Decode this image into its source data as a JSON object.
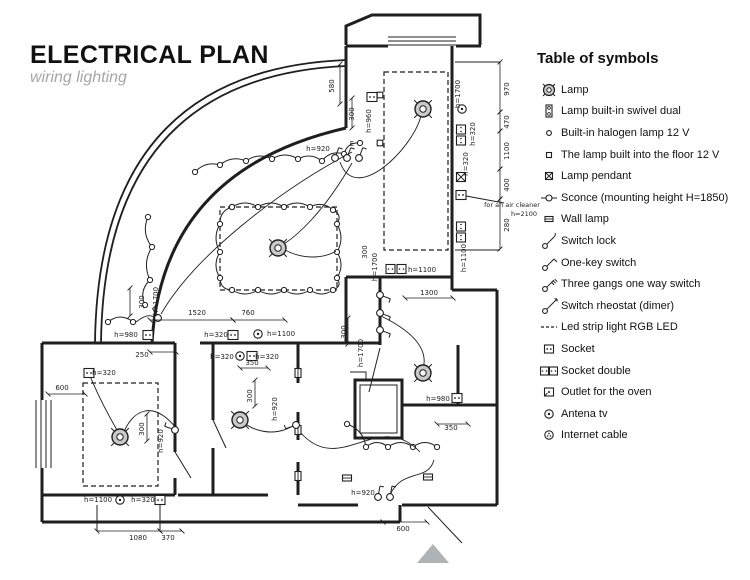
{
  "header": {
    "title": "ELECTRICAL PLAN",
    "subtitle": "wiring lighting"
  },
  "legend": {
    "title": "Table of symbols",
    "items": [
      {
        "icon": "lamp-icon",
        "label": "Lamp"
      },
      {
        "icon": "swivel-dual-lamp-icon",
        "label": "Lamp built-in swivel dual"
      },
      {
        "icon": "halogen-lamp-icon",
        "label": "Built-in halogen lamp 12 V"
      },
      {
        "icon": "floor-lamp-icon",
        "label": "The lamp built into the floor 12 V"
      },
      {
        "icon": "pendant-lamp-icon",
        "label": "Lamp pendant"
      },
      {
        "icon": "sconce-icon",
        "label": "Sconce (mounting height H=1850)"
      },
      {
        "icon": "wall-lamp-icon",
        "label": "Wall lamp"
      },
      {
        "icon": "switch-lock-icon",
        "label": "Switch lock"
      },
      {
        "icon": "one-key-switch-icon",
        "label": "One-key switch"
      },
      {
        "icon": "three-gangs-switch-icon",
        "label": "Three gangs one way switch"
      },
      {
        "icon": "switch-rheostat-icon",
        "label": "Switch rheostat (dimer)"
      },
      {
        "icon": "led-strip-icon",
        "label": "Led strip light RGB LED"
      },
      {
        "icon": "socket-icon",
        "label": "Socket"
      },
      {
        "icon": "socket-double-icon",
        "label": "Socket double"
      },
      {
        "icon": "oven-outlet-icon",
        "label": "Outlet for the oven"
      },
      {
        "icon": "antena-tv-icon",
        "label": "Antena tv"
      },
      {
        "icon": "internet-cable-icon",
        "label": "Internet cable"
      }
    ]
  },
  "plan": {
    "ink": "#1f1f1f",
    "lamp_fill": "#c9c9c9",
    "north_fill": "#b0b3b6",
    "walls_thick": [
      "M346,45 L346,26 L372,15 L480,15 L480,45",
      "M346,46 L388,46",
      "M456,46 L481,46",
      "M452,46 L452,290",
      "M346,277 L452,277",
      "M346,277 L346,343",
      "M380,277 L380,345",
      "M452,290 L497,290",
      "M497,290 L497,505",
      "M403,405 L497,405",
      "M458,345 L458,405",
      "M497,505 L430,505",
      "M400,505 L400,522",
      "M400,522 L42,522",
      "M42,522 L42,468",
      "M42,400 L42,343",
      "M42,343 L175,343",
      "M200,343 L380,343",
      "M175,343 L175,452",
      "M175,478 L175,495",
      "M42,495 L175,495",
      "M213,343 L213,420",
      "M213,448 L213,495",
      "M178,495 L268,495",
      "M298,343 L298,383",
      "M298,412 L298,440",
      "M298,462 L298,495",
      "M298,505 L358,505",
      "M402,505 L430,505",
      "M152,343 Q162,170 346,128",
      "M346,128 L346,46",
      "M355,380 L402,380 L402,438 L355,438 Z"
    ],
    "walls_med": [
      "M95,343 Q98,70 346,60",
      "M101,343 Q104,77 346,66"
    ],
    "walls_thin": [
      "M388,37 L456,37",
      "M388,41 L456,41",
      "M388,45 L456,45",
      "M36,400 L36,468",
      "M41,400 L41,468",
      "M46,400 L46,468",
      "M51,400 L51,468",
      "M360,385 L397,385 L397,433 L360,433 Z",
      "M350,372 L366,372 L366,380",
      "M175,452 L191,478",
      "M380,348 L369,392",
      "M428,507 L462,543",
      "M213,420 L226,448",
      "M455,62 L500,62",
      "M455,250 L500,250",
      "M466,196 L504,203",
      "M97,505 L97,531",
      "M160,505 L160,531"
    ],
    "dashed_rects": [
      [
        220,
        207,
        117,
        83
      ],
      [
        384,
        72,
        64,
        178
      ],
      [
        83,
        383,
        75,
        103
      ]
    ],
    "strings": [
      {
        "b": 9,
        "pts": [
          [
            148,
            217
          ],
          [
            152,
            247
          ],
          [
            150,
            280
          ],
          [
            145,
            305
          ]
        ]
      },
      {
        "b": -8,
        "pts": [
          [
            195,
            172
          ],
          [
            220,
            165
          ],
          [
            246,
            161
          ],
          [
            272,
            159
          ],
          [
            298,
            159
          ],
          [
            322,
            161
          ],
          [
            344,
            154
          ],
          [
            360,
            143
          ]
        ]
      },
      {
        "b": -9,
        "pts": [
          [
            347,
            424
          ],
          [
            366,
            447
          ],
          [
            388,
            447
          ],
          [
            413,
            447
          ],
          [
            437,
            447
          ]
        ]
      },
      {
        "b": -8,
        "pts": [
          [
            232,
            207
          ],
          [
            258,
            207
          ],
          [
            284,
            207
          ],
          [
            310,
            207
          ],
          [
            333,
            210
          ],
          [
            337,
            224
          ],
          [
            337,
            252
          ],
          [
            337,
            278
          ],
          [
            333,
            290
          ],
          [
            310,
            290
          ],
          [
            284,
            290
          ],
          [
            258,
            290
          ],
          [
            232,
            290
          ],
          [
            220,
            278
          ],
          [
            220,
            252
          ],
          [
            220,
            224
          ],
          [
            232,
            207
          ]
        ]
      },
      {
        "b": -10,
        "pts": [
          [
            108,
            322
          ],
          [
            133,
            322
          ]
        ]
      }
    ],
    "lamps": [
      [
        423,
        109
      ],
      [
        278,
        248
      ],
      [
        120,
        437
      ],
      [
        240,
        420
      ],
      [
        423,
        373
      ]
    ],
    "symbols": [
      {
        "x": 372,
        "y": 97,
        "k": "single",
        "rot": 0
      },
      {
        "x": 380,
        "y": 95,
        "k": "floor",
        "rot": 0
      },
      {
        "x": 380,
        "y": 143,
        "k": "floor",
        "rot": 0
      },
      {
        "x": 462,
        "y": 109,
        "k": "antena",
        "rot": 0
      },
      {
        "x": 461,
        "y": 135,
        "k": "double",
        "rot": 90
      },
      {
        "x": 461,
        "y": 177,
        "k": "pendant",
        "rot": 0
      },
      {
        "x": 461,
        "y": 195,
        "k": "single",
        "rot": 0
      },
      {
        "x": 461,
        "y": 232,
        "k": "double",
        "rot": 90
      },
      {
        "x": 396,
        "y": 269,
        "k": "double",
        "rot": 0
      },
      {
        "x": 148,
        "y": 335,
        "k": "single",
        "rot": 0
      },
      {
        "x": 233,
        "y": 335,
        "k": "single",
        "rot": 0
      },
      {
        "x": 258,
        "y": 334,
        "k": "antena",
        "rot": 0
      },
      {
        "x": 240,
        "y": 356,
        "k": "antena",
        "rot": 0
      },
      {
        "x": 252,
        "y": 356,
        "k": "single",
        "rot": 0
      },
      {
        "x": 89,
        "y": 373,
        "k": "single",
        "rot": 0
      },
      {
        "x": 120,
        "y": 500,
        "k": "antena",
        "rot": 0
      },
      {
        "x": 160,
        "y": 500,
        "k": "single",
        "rot": 0
      },
      {
        "x": 457,
        "y": 398,
        "k": "single",
        "rot": 0
      },
      {
        "x": 298,
        "y": 373,
        "k": "wall",
        "rot": 90
      },
      {
        "x": 298,
        "y": 430,
        "k": "wall",
        "rot": 90
      },
      {
        "x": 298,
        "y": 476,
        "k": "wall",
        "rot": 90
      },
      {
        "x": 347,
        "y": 478,
        "k": "wall",
        "rot": 0
      },
      {
        "x": 428,
        "y": 477,
        "k": "wall",
        "rot": 0
      }
    ],
    "switches": [
      {
        "x": 335,
        "y": 158,
        "a": -70
      },
      {
        "x": 347,
        "y": 158,
        "a": -70
      },
      {
        "x": 359,
        "y": 158,
        "a": -70
      },
      {
        "x": 380,
        "y": 295,
        "a": 20
      },
      {
        "x": 380,
        "y": 313,
        "a": 20
      },
      {
        "x": 380,
        "y": 330,
        "a": 20
      },
      {
        "x": 175,
        "y": 430,
        "a": -160
      },
      {
        "x": 296,
        "y": 425,
        "a": 160
      },
      {
        "x": 158,
        "y": 318,
        "a": -120
      },
      {
        "x": 378,
        "y": 497,
        "a": -80
      },
      {
        "x": 390,
        "y": 497,
        "a": -80
      }
    ],
    "wires": [
      "M340,162 C355,205 412,150 421,116",
      "M352,163 C322,215 296,236 284,244",
      "M381,316 C418,334 428,352 423,369",
      "M176,428 C152,398 132,412 124,432",
      "M90,376 C100,400 110,418 117,430",
      "M296,424 C272,440 250,428 243,422",
      "M352,152 C280,190 195,255 161,314",
      "M285,250 C308,262 328,256 336,251",
      "M300,432 C340,478 378,408 420,452",
      "M390,495 C402,468 428,482 434,460",
      "M136,322 C146,314 152,314 156,319"
    ],
    "dims": [
      [
        500,
        62,
        500,
        112
      ],
      [
        500,
        112,
        500,
        131
      ],
      [
        500,
        131,
        500,
        169
      ],
      [
        500,
        169,
        500,
        199
      ],
      [
        500,
        199,
        500,
        249
      ],
      [
        150,
        320,
        233,
        320
      ],
      [
        233,
        320,
        285,
        320
      ],
      [
        405,
        298,
        453,
        298
      ],
      [
        97,
        531,
        160,
        531
      ],
      [
        160,
        531,
        182,
        531
      ],
      [
        383,
        522,
        427,
        522
      ],
      [
        48,
        394,
        85,
        394
      ],
      [
        437,
        424,
        468,
        424
      ],
      [
        240,
        368,
        268,
        368
      ],
      [
        130,
        288,
        130,
        316
      ],
      [
        255,
        380,
        255,
        406
      ],
      [
        147,
        414,
        147,
        441
      ],
      [
        348,
        318,
        348,
        344
      ],
      [
        340,
        64,
        340,
        104
      ],
      [
        352,
        98,
        352,
        128
      ],
      [
        150,
        352,
        176,
        352
      ]
    ],
    "labels": [
      {
        "x": 334,
        "y": 86,
        "t": "580",
        "r": -90
      },
      {
        "x": 354,
        "y": 114,
        "t": "300",
        "r": -90
      },
      {
        "x": 371,
        "y": 121,
        "t": "h=960",
        "r": -90
      },
      {
        "x": 318,
        "y": 151,
        "t": "h=920",
        "r": 0
      },
      {
        "x": 352,
        "y": 146,
        "t": "Е",
        "r": 0
      },
      {
        "x": 460,
        "y": 94,
        "t": "h=1700",
        "r": -90
      },
      {
        "x": 509,
        "y": 89,
        "t": "970",
        "r": -90
      },
      {
        "x": 475,
        "y": 134,
        "t": "h=320",
        "r": -90
      },
      {
        "x": 509,
        "y": 122,
        "t": "470",
        "r": -90
      },
      {
        "x": 509,
        "y": 151,
        "t": "1100",
        "r": -90
      },
      {
        "x": 468,
        "y": 164,
        "t": "h=320",
        "r": -90
      },
      {
        "x": 509,
        "y": 185,
        "t": "400",
        "r": -90
      },
      {
        "x": 512,
        "y": 207,
        "t": "for an air cleaner",
        "r": 0,
        "s": 6.5
      },
      {
        "x": 524,
        "y": 216,
        "t": "h=2100",
        "r": 0,
        "s": 6.5
      },
      {
        "x": 509,
        "y": 225,
        "t": "280",
        "r": -90
      },
      {
        "x": 466,
        "y": 258,
        "t": "h=1100",
        "r": -90
      },
      {
        "x": 422,
        "y": 272,
        "t": "h=1100",
        "r": 0
      },
      {
        "x": 429,
        "y": 295,
        "t": "1300",
        "r": 0
      },
      {
        "x": 367,
        "y": 252,
        "t": "300",
        "r": -90
      },
      {
        "x": 377,
        "y": 267,
        "t": "h=1700",
        "r": -90
      },
      {
        "x": 158,
        "y": 301,
        "t": "h=1700",
        "r": -90
      },
      {
        "x": 144,
        "y": 302,
        "t": "300",
        "r": -90
      },
      {
        "x": 197,
        "y": 315,
        "t": "1520",
        "r": 0
      },
      {
        "x": 248,
        "y": 315,
        "t": "760",
        "r": 0
      },
      {
        "x": 126,
        "y": 337,
        "t": "h=980",
        "r": 0
      },
      {
        "x": 216,
        "y": 337,
        "t": "h=320",
        "r": 0
      },
      {
        "x": 281,
        "y": 336,
        "t": "h=1100",
        "r": 0
      },
      {
        "x": 142,
        "y": 357,
        "t": "250",
        "r": 0
      },
      {
        "x": 222,
        "y": 359,
        "t": "h=320",
        "r": 0
      },
      {
        "x": 267,
        "y": 359,
        "t": "h=320",
        "r": 0
      },
      {
        "x": 252,
        "y": 365,
        "t": "350",
        "r": 0
      },
      {
        "x": 252,
        "y": 396,
        "t": "300",
        "r": -90
      },
      {
        "x": 277,
        "y": 409,
        "t": "h=920",
        "r": -90
      },
      {
        "x": 104,
        "y": 375,
        "t": "h=320",
        "r": 0
      },
      {
        "x": 62,
        "y": 390,
        "t": "600",
        "r": 0
      },
      {
        "x": 144,
        "y": 429,
        "t": "300",
        "r": -90
      },
      {
        "x": 163,
        "y": 441,
        "t": "h=920",
        "r": -90
      },
      {
        "x": 98,
        "y": 502,
        "t": "h=1100",
        "r": 0
      },
      {
        "x": 143,
        "y": 502,
        "t": "h=320",
        "r": 0
      },
      {
        "x": 138,
        "y": 540,
        "t": "1080",
        "r": 0
      },
      {
        "x": 168,
        "y": 540,
        "t": "370",
        "r": 0
      },
      {
        "x": 346,
        "y": 332,
        "t": "300",
        "r": -90
      },
      {
        "x": 363,
        "y": 353,
        "t": "h=1700",
        "r": -90
      },
      {
        "x": 363,
        "y": 495,
        "t": "h=920",
        "r": 0
      },
      {
        "x": 403,
        "y": 531,
        "t": "600",
        "r": 0
      },
      {
        "x": 438,
        "y": 401,
        "t": "h=980",
        "r": 0
      },
      {
        "x": 451,
        "y": 430,
        "t": "350",
        "r": 0
      }
    ],
    "north": "417,563 433,544 449,563"
  }
}
